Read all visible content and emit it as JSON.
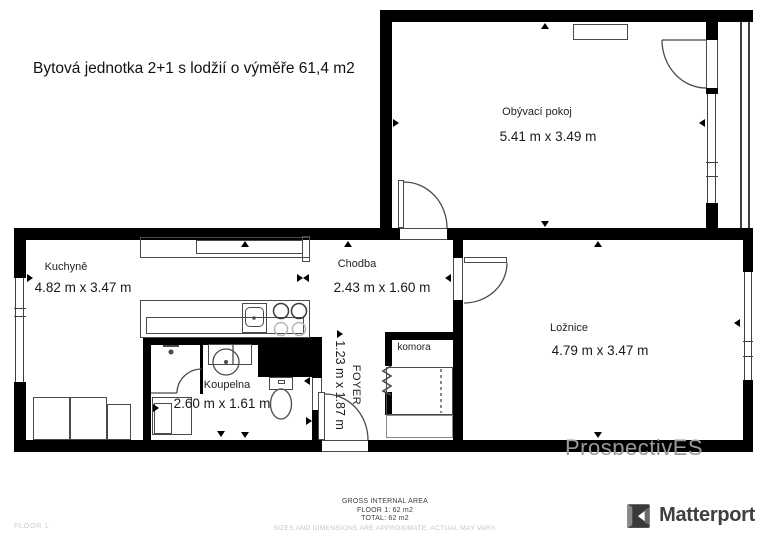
{
  "title": "Bytová jednotka 2+1 s lodžií o výměře 61,4 m2",
  "rooms": {
    "living_room": {
      "label": "Obývací pokoj",
      "dimensions": "5.41 m x 3.49 m"
    },
    "kitchen": {
      "label": "Kuchyně",
      "dimensions": "4.82 m x 3.47 m"
    },
    "hallway": {
      "label": "Chodba",
      "dimensions": "2.43 m x 1.60 m"
    },
    "bedroom": {
      "label": "Ložnice",
      "dimensions": "4.79 m x 3.47 m"
    },
    "bathroom": {
      "label": "Koupelna",
      "dimensions": "2.60 m x 1.61 m"
    },
    "pantry": {
      "label": "komora"
    },
    "foyer": {
      "label": "FOYER",
      "dimensions": "1.23 m x 1.87 m"
    }
  },
  "footer": {
    "area_title": "GROSS INTERNAL AREA",
    "floor_area": "FLOOR 1: 62 m2",
    "total_area": "TOTAL: 62 m2",
    "disclaimer": "SIZES AND DIMENSIONS ARE APPROXIMATE, ACTUAL MAY VARY.",
    "floor_label": "FLOOR 1"
  },
  "branding": {
    "name": "Matterport"
  },
  "watermark": "ProspectivES",
  "colors": {
    "wall": "#000000",
    "fixture_line": "#4a4a4a",
    "watermark": "#98999b",
    "muted_text": "#c6c6c6",
    "brand_text": "#3f3f3f"
  }
}
